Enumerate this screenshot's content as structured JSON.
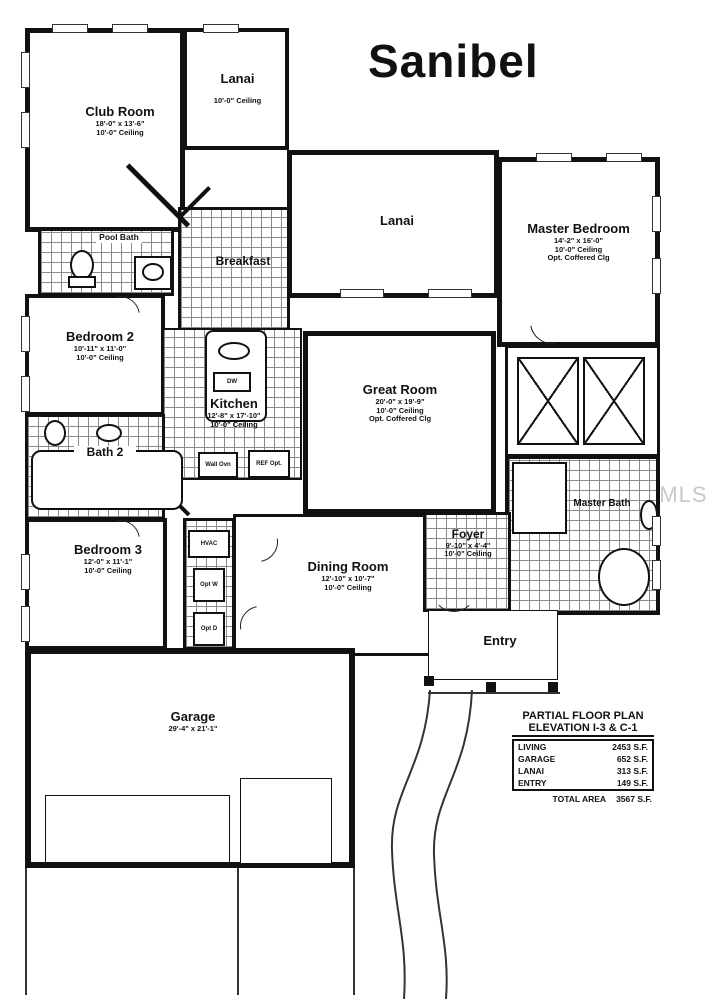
{
  "title": "Sanibel",
  "watermark": "StellarMLS",
  "rooms": {
    "club_room": {
      "name": "Club Room",
      "dims": "18'-0\" x 13'-6\"",
      "ceiling": "10'-0\" Ceiling"
    },
    "lanai_top": {
      "name": "Lanai",
      "ceiling": "10'-0\" Ceiling"
    },
    "pool_bath": {
      "name": "Pool Bath"
    },
    "breakfast": {
      "name": "Breakfast"
    },
    "lanai_mid": {
      "name": "Lanai"
    },
    "master_bedroom": {
      "name": "Master Bedroom",
      "dims": "14'-2\" x 16'-0\"",
      "ceiling": "10'-0\" Ceiling",
      "option": "Opt. Coffered Clg"
    },
    "bedroom2": {
      "name": "Bedroom 2",
      "dims": "10'-11\" x 11'-0\"",
      "ceiling": "10'-0\" Ceiling"
    },
    "kitchen": {
      "name": "Kitchen",
      "dims": "12'-8\" x 17'-10\"",
      "ceiling": "10'-0\" Ceiling"
    },
    "great_room": {
      "name": "Great Room",
      "dims": "20'-0\" x 19'-9\"",
      "ceiling": "10'-0\" Ceiling",
      "option": "Opt. Coffered Clg"
    },
    "bath2": {
      "name": "Bath 2"
    },
    "bedroom3": {
      "name": "Bedroom 3",
      "dims": "12'-0\" x 11'-1\"",
      "ceiling": "10'-0\" Ceiling"
    },
    "dining_room": {
      "name": "Dining Room",
      "dims": "12'-10\" x 10'-7\"",
      "ceiling": "10'-0\" Ceiling"
    },
    "foyer": {
      "name": "Foyer",
      "dims": "9'-10\" x 4'-4\"",
      "ceiling": "10'-0\" Ceiling"
    },
    "master_bath": {
      "name": "Master Bath"
    },
    "entry": {
      "name": "Entry"
    },
    "garage": {
      "name": "Garage",
      "dims": "29'-4\" x 21'-1\""
    }
  },
  "appliances": {
    "dw": "DW",
    "wall_oven": "Wall Ovn",
    "ref": "REF Opt.",
    "hvac": "HVAC",
    "opt_w": "Opt W",
    "opt_d": "Opt D"
  },
  "area_table": {
    "title_line1": "PARTIAL FLOOR PLAN",
    "title_line2": "ELEVATION I-3 & C-1",
    "rows": [
      {
        "label": "LIVING",
        "value": "2453 S.F."
      },
      {
        "label": "GARAGE",
        "value": "652 S.F."
      },
      {
        "label": "LANAI",
        "value": "313 S.F."
      },
      {
        "label": "ENTRY",
        "value": "149 S.F."
      }
    ],
    "total_label": "TOTAL AREA",
    "total_value": "3567 S.F."
  },
  "colors": {
    "line": "#111111",
    "watermark": "#c9c9c9",
    "background": "#ffffff"
  }
}
